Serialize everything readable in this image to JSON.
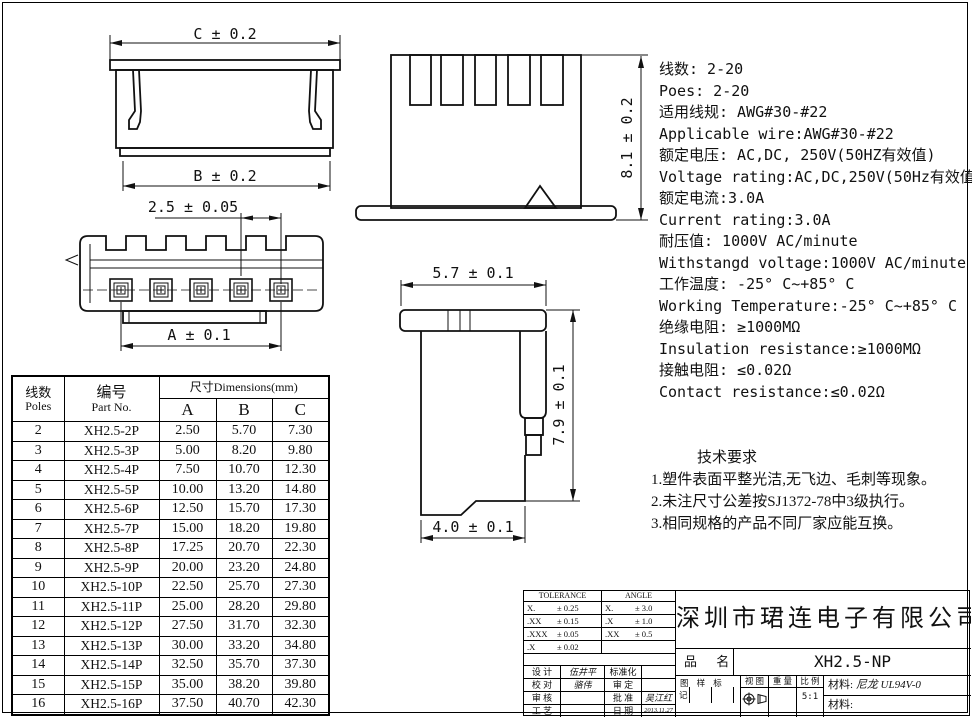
{
  "drawings": {
    "front_view": {
      "dim_top": "C ± 0.2",
      "dim_bottom": "B ± 0.2"
    },
    "pin_view": {
      "dim_pitch": "2.5 ± 0.05",
      "dim_span": "A ± 0.1"
    },
    "side_view": {
      "dim_height": "8.1 ± 0.2"
    },
    "profile_view": {
      "dim_top": "5.7 ± 0.1",
      "dim_height": "7.9 ± 0.1",
      "dim_bottom": "4.0 ± 0.1"
    }
  },
  "specs": {
    "lines": [
      "线数: 2-20",
      "Poes: 2-20",
      "适用线规: AWG#30-#22",
      "Applicable wire:AWG#30-#22",
      "额定电压: AC,DC, 250V(50HZ有效值)",
      "Voltage rating:AC,DC,250V(50Hz有效值)",
      "额定电流:3.0A",
      "Current rating:3.0A",
      "耐压值: 1000V AC/minute",
      "Withstangd voltage:1000V AC/minute",
      "工作温度: -25° C~+85° C",
      "Working Temperature:-25° C~+85° C",
      "绝缘电阻: ≥1000MΩ",
      "Insulation resistance:≥1000MΩ",
      "接触电阻: ≤0.02Ω",
      "Contact resistance:≤0.02Ω"
    ]
  },
  "tech_requirements": {
    "title": "技术要求",
    "items": [
      "1.塑件表面平整光洁,无飞边、毛刺等现象。",
      "2.未注尺寸公差按SJ1372-78中3级执行。",
      "3.相同规格的产品不同厂家应能互换。"
    ]
  },
  "table": {
    "header": {
      "poles_zh": "线数",
      "poles_en": "Poles",
      "part_zh": "编号",
      "part_en": "Part No.",
      "dims": "尺寸Dimensions(mm)",
      "col_a": "A",
      "col_b": "B",
      "col_c": "C"
    },
    "rows": [
      {
        "poles": "2",
        "part": "XH2.5-2P",
        "a": "2.50",
        "b": "5.70",
        "c": "7.30"
      },
      {
        "poles": "3",
        "part": "XH2.5-3P",
        "a": "5.00",
        "b": "8.20",
        "c": "9.80"
      },
      {
        "poles": "4",
        "part": "XH2.5-4P",
        "a": "7.50",
        "b": "10.70",
        "c": "12.30"
      },
      {
        "poles": "5",
        "part": "XH2.5-5P",
        "a": "10.00",
        "b": "13.20",
        "c": "14.80"
      },
      {
        "poles": "6",
        "part": "XH2.5-6P",
        "a": "12.50",
        "b": "15.70",
        "c": "17.30"
      },
      {
        "poles": "7",
        "part": "XH2.5-7P",
        "a": "15.00",
        "b": "18.20",
        "c": "19.80"
      },
      {
        "poles": "8",
        "part": "XH2.5-8P",
        "a": "17.25",
        "b": "20.70",
        "c": "22.30"
      },
      {
        "poles": "9",
        "part": "XH2.5-9P",
        "a": "20.00",
        "b": "23.20",
        "c": "24.80"
      },
      {
        "poles": "10",
        "part": "XH2.5-10P",
        "a": "22.50",
        "b": "25.70",
        "c": "27.30"
      },
      {
        "poles": "11",
        "part": "XH2.5-11P",
        "a": "25.00",
        "b": "28.20",
        "c": "29.80"
      },
      {
        "poles": "12",
        "part": "XH2.5-12P",
        "a": "27.50",
        "b": "31.70",
        "c": "32.30"
      },
      {
        "poles": "13",
        "part": "XH2.5-13P",
        "a": "30.00",
        "b": "33.20",
        "c": "34.80"
      },
      {
        "poles": "14",
        "part": "XH2.5-14P",
        "a": "32.50",
        "b": "35.70",
        "c": "37.30"
      },
      {
        "poles": "15",
        "part": "XH2.5-15P",
        "a": "35.00",
        "b": "38.20",
        "c": "39.80"
      },
      {
        "poles": "16",
        "part": "XH2.5-16P",
        "a": "37.50",
        "b": "40.70",
        "c": "42.30"
      }
    ]
  },
  "title_block": {
    "tolerance": {
      "title": "TOLERANCE",
      "rows": [
        {
          "label": "X.",
          "value": "± 0.25"
        },
        {
          "label": ".XX",
          "value": "± 0.15"
        },
        {
          "label": ".XXX",
          "value": "± 0.05"
        },
        {
          "label": ".X",
          "value": "± 0.02"
        }
      ]
    },
    "angle": {
      "title": "ANGLE",
      "rows": [
        {
          "label": "X.",
          "value": "± 3.0"
        },
        {
          "label": ".X",
          "value": "± 1.0"
        },
        {
          "label": ".XX",
          "value": "± 0.5"
        },
        {
          "label": "",
          "value": ""
        }
      ]
    },
    "signatures": [
      {
        "label": "设 计",
        "value": "伍井平",
        "label2": "标准化",
        "value2": ""
      },
      {
        "label": "校 对",
        "value": "骆伟",
        "label2": "审 定",
        "value2": ""
      },
      {
        "label": "审 核",
        "value": "",
        "label2": "批 准",
        "value2": "吴江红"
      },
      {
        "label": "工 艺",
        "value": "",
        "label2": "日 期",
        "value2": "2013.11.27"
      }
    ],
    "company": "深圳市珺连电子有限公司",
    "product_label": "品 名",
    "product_name": "XH2.5-NP",
    "stamp_label": "图 样 标",
    "stamp_label2": "记",
    "view_label": "视 图",
    "weight_label": "重 量",
    "scale_label": "比 例",
    "scale_value": "5:1",
    "material1_label": "材料:",
    "material1_value": "尼龙 UL94V-0",
    "material2_label": "材料:"
  }
}
